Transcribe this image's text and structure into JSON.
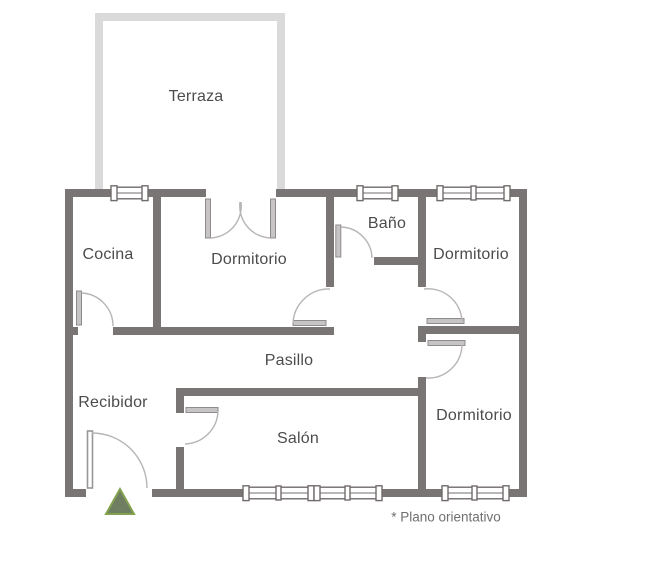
{
  "floorplan": {
    "rooms": {
      "terraza": {
        "label": "Terraza"
      },
      "cocina": {
        "label": "Cocina"
      },
      "dormitorio_top": {
        "label": "Dormitorio"
      },
      "bano": {
        "label": "Baño"
      },
      "dormitorio_right_top": {
        "label": "Dormitorio"
      },
      "pasillo": {
        "label": "Pasillo"
      },
      "recibidor": {
        "label": "Recibidor"
      },
      "salon": {
        "label": "Salón"
      },
      "dormitorio_right_bottom": {
        "label": "Dormitorio"
      }
    },
    "footnote": "* Plano orientativo",
    "colors": {
      "wall": "#7a7575",
      "terrace_wall": "#dadada",
      "door_leaf": "#c6c4c4",
      "door_leaf_stroke": "#8f8b8b",
      "door_arc": "#b7b4b4",
      "window_frame": "#716c6c",
      "text": "#4c4c4c",
      "footnote_text": "#6f6f6f",
      "entrance_fill": "#6f7d60",
      "entrance_stroke": "#82a24f"
    }
  }
}
